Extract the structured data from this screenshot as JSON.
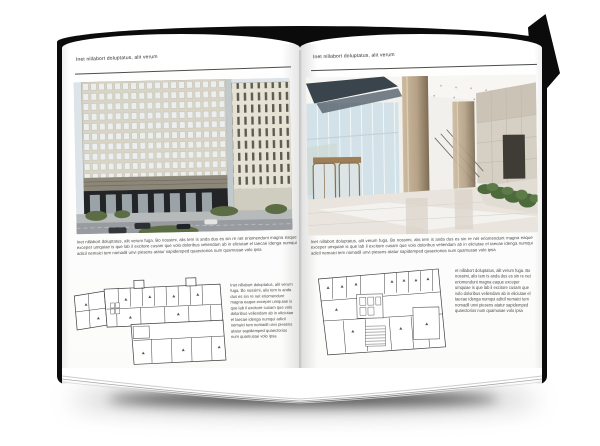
{
  "spread": {
    "left_page": {
      "header": "Inet nillabort doluptatus, alit verum",
      "body": "Inet nillabort doluptatus, alit verum fuga. Bo nossimi, alis tem is anda dus es sin re net eriomendunt magna eaque exceper umquiae is que lab il excitore cusam que volo doloribus veliendam ab in eliciutae el taecae idenga numqui adicil nemaici tem nomadil unvi piesens atatur sapidemped quaectorios num quamusae volo ipsa",
      "caption": "Inet nillabort doluptatus, alit verum fuga. Bo nossimi, alis tem is anda dus es sin re net eriomendunt magna eaque exceper umquiae is que lab il excitore cusam que volo doloribus veliendam ab in eliciutae el taecae idenga numqui adicil nemaici tem nomadil unvi piesens atatur sapidemped quaectorios num quamusae volo ipsa",
      "photo_alt": "office building exterior photograph",
      "plan_alt": "floor plan drawing"
    },
    "right_page": {
      "header": "Inet nillabort doluptatus, alit verum",
      "body": "Inet nillabort doluptatus, alit verum fuga. Bo nossimi, alis tem is anda dus es sin re net eriomendunt magna eaque exceper umquiae is que lab il excitore cusam que volo doloribus veliendam ab in eliciutae el taecae idenga numqui adicil nemaici tem nomadil unvi piesens atatur sapidemped quaectorios num quamusae volo ipsa",
      "caption": "et nillabort doluptatus, alit verum fuga. Bo nossimi, alis tem is anda dus es sin re net eriomendunt magna eaque exceper umquiae is que lab il excitore cusam que volo doloribus veliendam ab in eliciutae el taecae idenga numqui adicil nemaici tem nomadil unvi piesens atatur sapidemped quaectorios num quamusae volo ipsa",
      "photo_alt": "building lobby interior photograph",
      "plan_alt": "floor plan drawing"
    }
  },
  "colors": {
    "cover": "#0b0b0b",
    "page": "#ffffff",
    "rule": "#4d4d4d",
    "header_text": "#2e2e2e",
    "body_text": "#4a4a4a",
    "facade_cream": "#d8d4c6",
    "facade_base_dark": "#222426",
    "glass_blue": "#d3e2e8",
    "column_tan": "#c0ad8f",
    "plant_green": "#4c6a3c"
  }
}
